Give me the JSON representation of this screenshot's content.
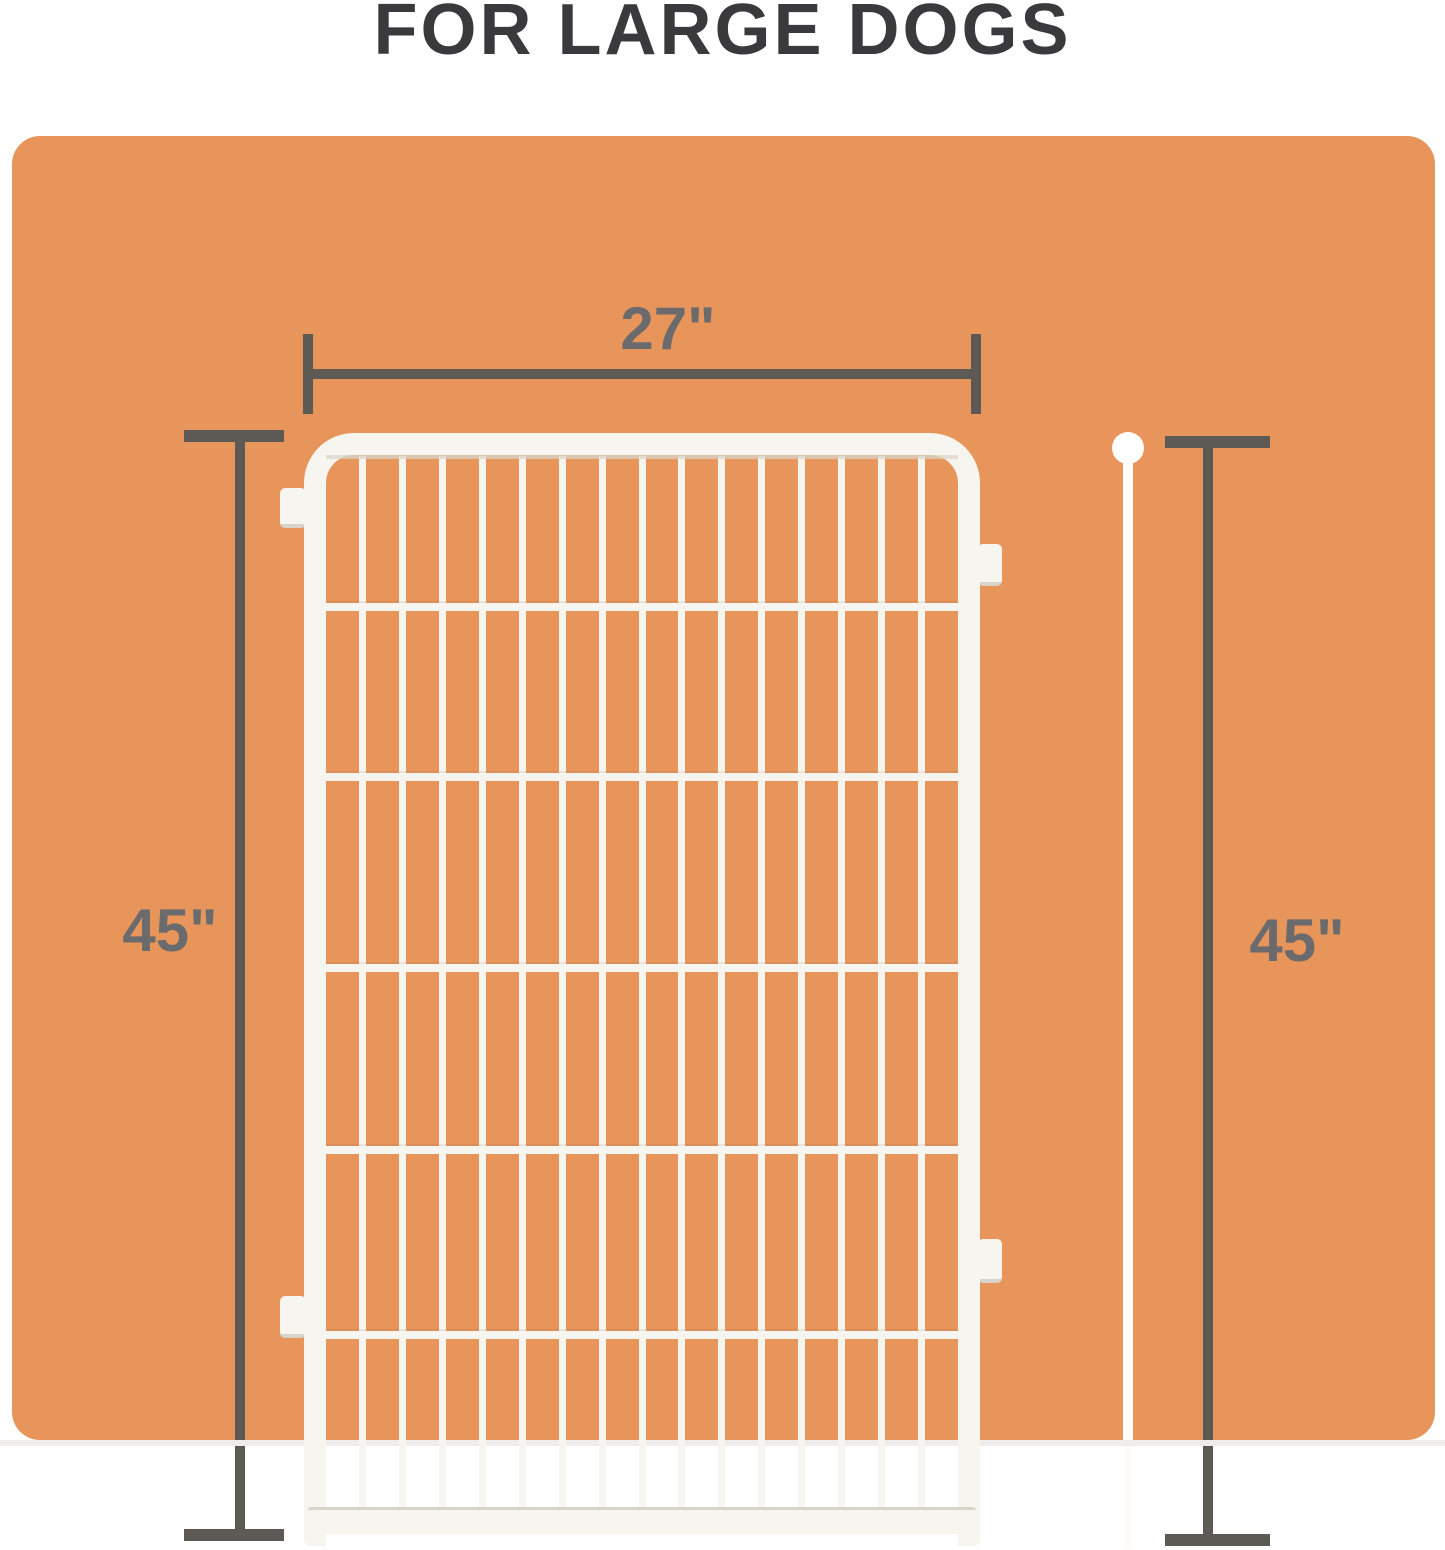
{
  "title": "FOR LARGE DOGS",
  "dimensions": {
    "width": {
      "label": "27\""
    },
    "height_left": {
      "label": "45\""
    },
    "height_right": {
      "label": "45\""
    }
  },
  "panel": {
    "vertical_wires": 15,
    "horizontal_wire_positions_pct": [
      14.0,
      30.1,
      48.3,
      65.6,
      83.2
    ]
  },
  "colors": {
    "background": "#ffffff",
    "card": "#e7955a",
    "dimension_lines": "#5d5954",
    "dimension_text": "#6b6b6d",
    "title_text": "#3a3a3c",
    "panel_white": "#f7f5f0",
    "panel_shadow": "#d9d4ca",
    "bottom_strip": "#efede9",
    "pole_white": "#fdfcf8"
  }
}
